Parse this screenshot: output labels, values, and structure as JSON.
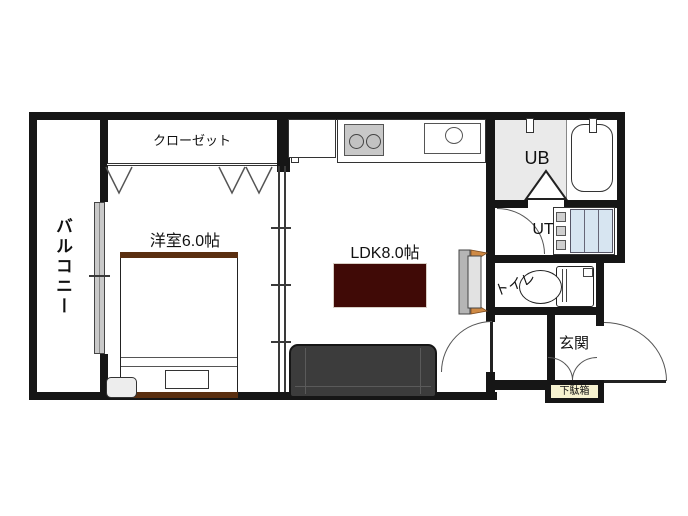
{
  "figure": {
    "type": "apartment-floorplan",
    "orientation": "1K/1LDK single-unit plan"
  },
  "rooms": {
    "balcony": "バルコニー",
    "closet": "クローゼット",
    "bedroom": "洋室6.0帖",
    "ldk": "LDK8.0帖",
    "unit_bath": "UB",
    "utility": "UT",
    "toilet": "トイレ",
    "entrance": "玄関",
    "shoe_cabinet": "下駄箱"
  },
  "colors": {
    "wall": "#161616",
    "rug": "#400a06",
    "sofa": "#3c3c3c",
    "bed_frame_wood": "#5a2f10",
    "unit_bath_fill": "#eaeaea",
    "washer_blue": "#d7e5f1",
    "shoe_cabinet_fill": "#f6f2d0",
    "door_wood_accent": "#cf8a45",
    "stove_gray": "#c8c8c8",
    "window_gray": "#c9c9c9"
  }
}
